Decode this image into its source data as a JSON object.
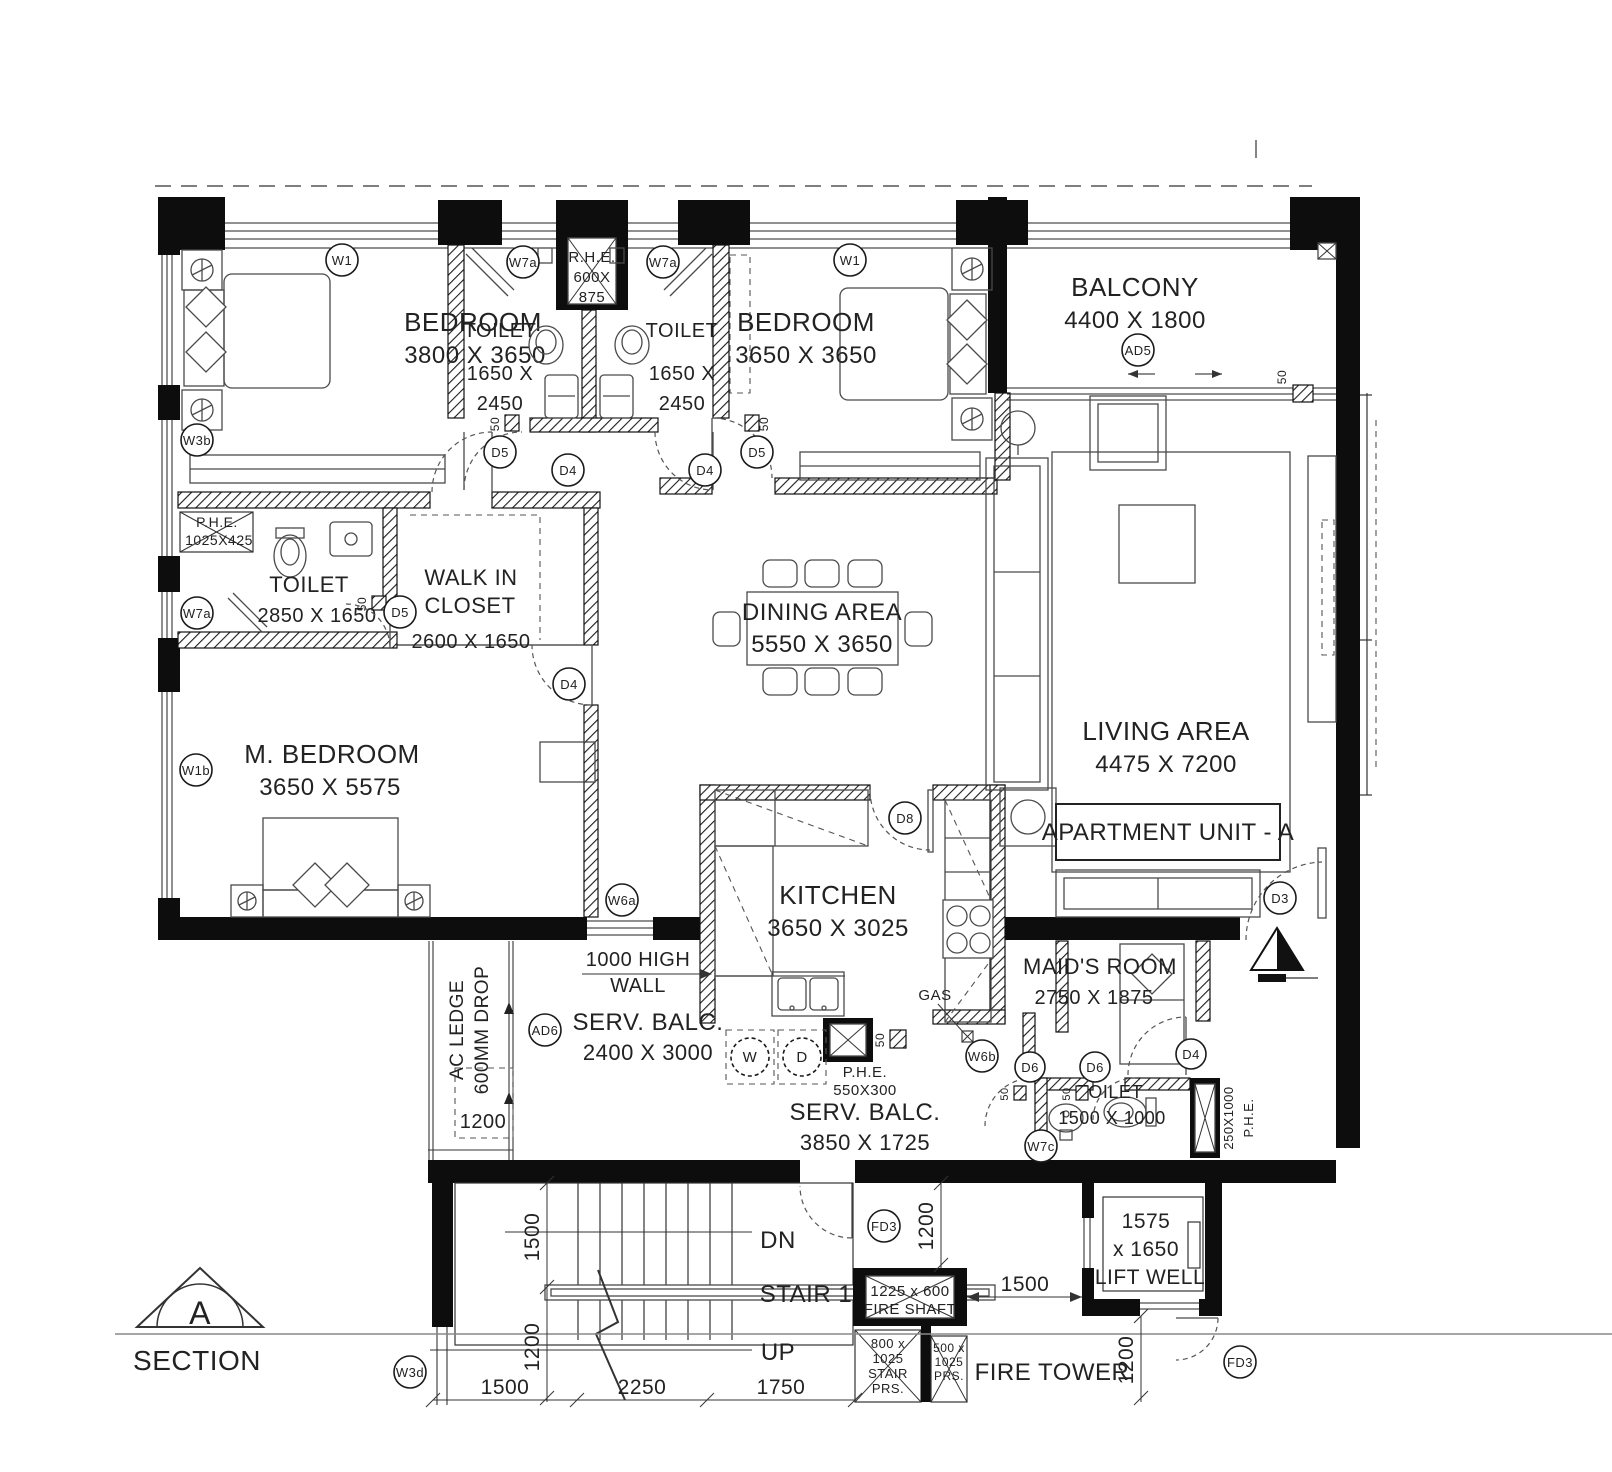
{
  "section": {
    "letter": "A",
    "label": "SECTION"
  },
  "unit_label": "APARTMENT UNIT - A",
  "rooms": {
    "bedroom1": {
      "name": "BEDROOM",
      "dims": "3800 X 3650"
    },
    "bedroom2": {
      "name": "BEDROOM",
      "dims": "3650 X 3650"
    },
    "toilet_shared": {
      "name": "TOILET",
      "dims_l1": "1650 X",
      "dims_l2": "2450"
    },
    "balcony": {
      "name": "BALCONY",
      "dims": "4400 X 1800"
    },
    "master_toilet": {
      "name": "TOILET",
      "dims": "2850 X 1650"
    },
    "walk_in_closet": {
      "name_l1": "WALK IN",
      "name_l2": "CLOSET",
      "dims": "2600 X 1650"
    },
    "dining": {
      "name": "DINING AREA",
      "dims": "5550 X 3650"
    },
    "living": {
      "name": "LIVING AREA",
      "dims": "4475 X 7200"
    },
    "master_bedroom": {
      "name": "M. BEDROOM",
      "dims": "3650 X 5575"
    },
    "kitchen": {
      "name": "KITCHEN",
      "dims": "3650 X 3025"
    },
    "maids_room": {
      "name": "MAID'S ROOM",
      "dims": "2750 X 1875"
    },
    "serv_balc_1": {
      "name": "SERV. BALC.",
      "dims": "2400 X 3000"
    },
    "serv_balc_2": {
      "name": "SERV. BALC.",
      "dims": "3850 X 1725"
    },
    "maid_toilet": {
      "name": "TOILET",
      "dims": "1500 X 1000"
    },
    "lift_well": {
      "l1": "1575",
      "l2": "x 1650",
      "l3": "LIFT WELL"
    },
    "stair": {
      "name": "STAIR 1"
    },
    "fire_tower": {
      "name": "FIRE TOWER"
    },
    "fire_shaft": {
      "l1": "1225 x 600",
      "l2": "FIRE SHAFT"
    },
    "stair_prs": {
      "l1": "800 x",
      "l2": "1025",
      "l3": "STAIR",
      "l4": "PRS."
    },
    "prs": {
      "l1": "500 x",
      "l2": "1025",
      "l3": "PRS."
    },
    "ac_ledge": {
      "l1": "AC LEDGE",
      "l2": "600MM DROP"
    }
  },
  "annotations": {
    "rhe": {
      "l1": "R.H.E.",
      "l2": "600X",
      "l3": "875"
    },
    "phe_closet": {
      "l1": "P.H.E.",
      "l2": "1025X425"
    },
    "phe_serv": {
      "l1": "P.H.E.",
      "l2": "550X300"
    },
    "phe_maid": {
      "l1": "P.H.E.",
      "l2": "250X1000"
    },
    "gas": "GAS",
    "high_wall": {
      "l1": "1000 HIGH",
      "l2": "WALL"
    },
    "dn": "DN",
    "up": "UP",
    "washer": "W",
    "dryer": "D",
    "gap_50": "50"
  },
  "markers": {
    "w1": "W1",
    "w3b": "W3b",
    "w1b": "W1b",
    "w3d": "W3d",
    "w6a": "W6a",
    "w6b": "W6b",
    "w7a": "W7a",
    "w7c": "W7c",
    "d3": "D3",
    "d4": "D4",
    "d5": "D5",
    "d6": "D6",
    "d8": "D8",
    "ad5": "AD5",
    "ad6": "AD6",
    "fd3": "FD3"
  },
  "dimensions": {
    "dim_1500": "1500",
    "dim_2250": "2250",
    "dim_1750": "1750",
    "dim_1200": "1200"
  }
}
